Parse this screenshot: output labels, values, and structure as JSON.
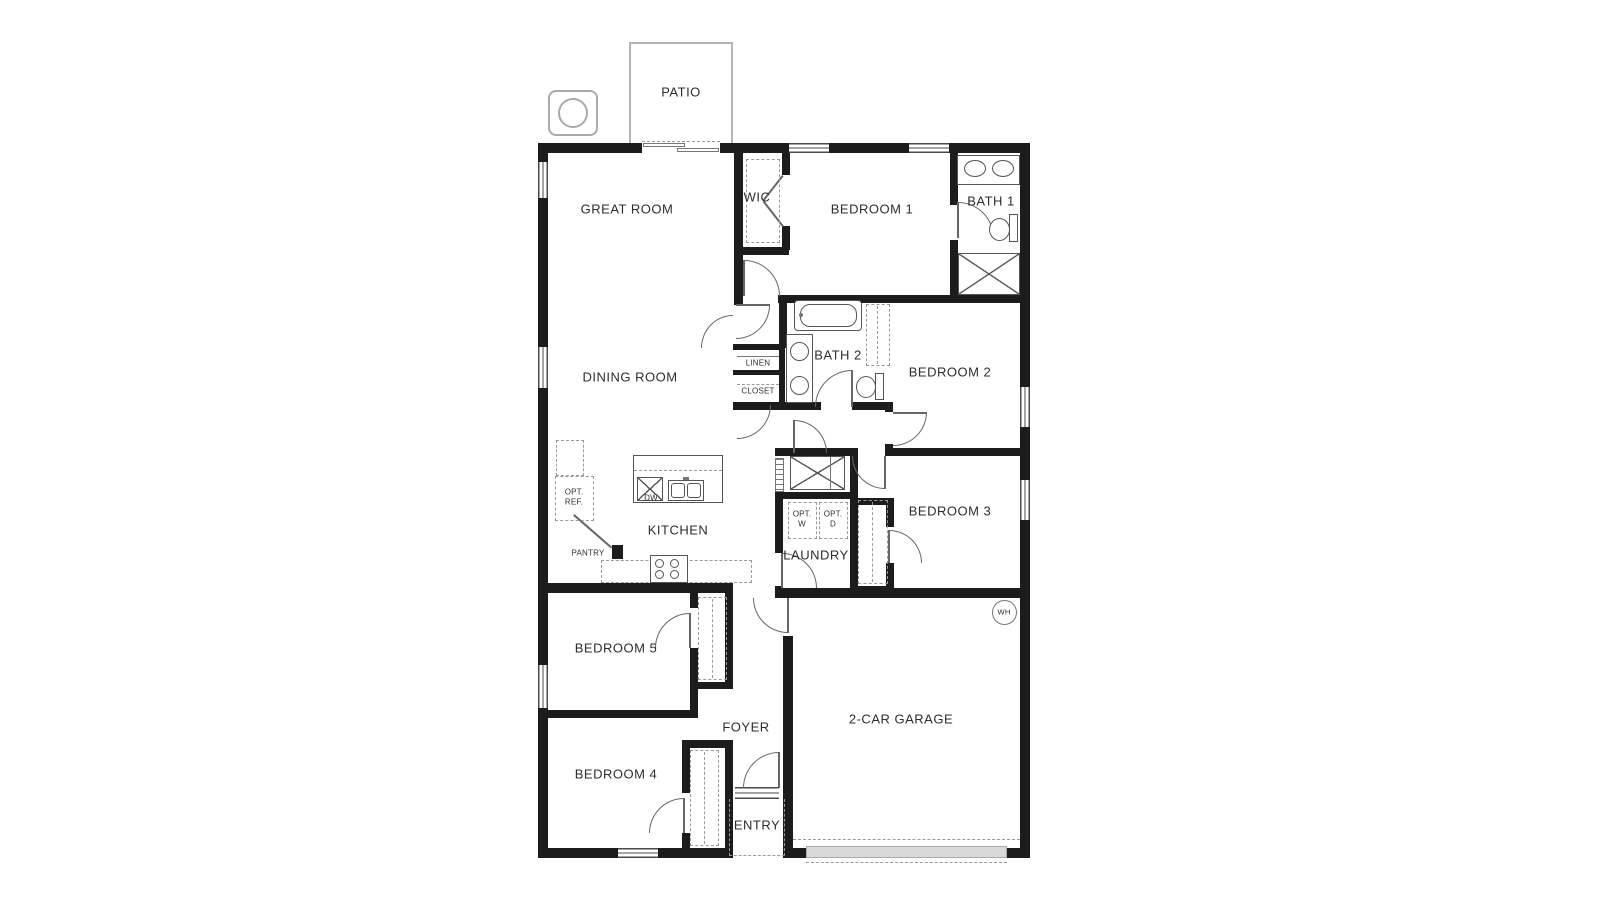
{
  "plan": {
    "rooms": {
      "patio": "PATIO",
      "great_room": "GREAT ROOM",
      "wic": "WIC",
      "bedroom1": "BEDROOM 1",
      "bath1": "BATH 1",
      "dining": "DINING ROOM",
      "bath2": "BATH 2",
      "bedroom2": "BEDROOM 2",
      "bedroom3": "BEDROOM 3",
      "kitchen": "KITCHEN",
      "laundry": "LAUNDRY",
      "bedroom5": "BEDROOM 5",
      "foyer": "FOYER",
      "bedroom4": "BEDROOM 4",
      "entry": "ENTRY",
      "garage": "2-CAR GARAGE"
    },
    "closets": {
      "linen": "LINEN",
      "closet": "CLOSET",
      "pantry": "PANTRY"
    },
    "labels": {
      "opt_ref_1": "OPT.",
      "opt_ref_2": "REF.",
      "dw": "DW",
      "opt_w_1": "OPT.",
      "opt_w_2": "W",
      "opt_d_1": "OPT.",
      "opt_d_2": "D",
      "wh": "WH"
    },
    "colors": {
      "wall": "#1c1c1c",
      "fixture_line": "#555555",
      "dash": "#9a9a9a",
      "patio_outline": "#b5b5b5",
      "garage_sill": "#d9d9d9",
      "label": "#2d2d2d"
    }
  }
}
